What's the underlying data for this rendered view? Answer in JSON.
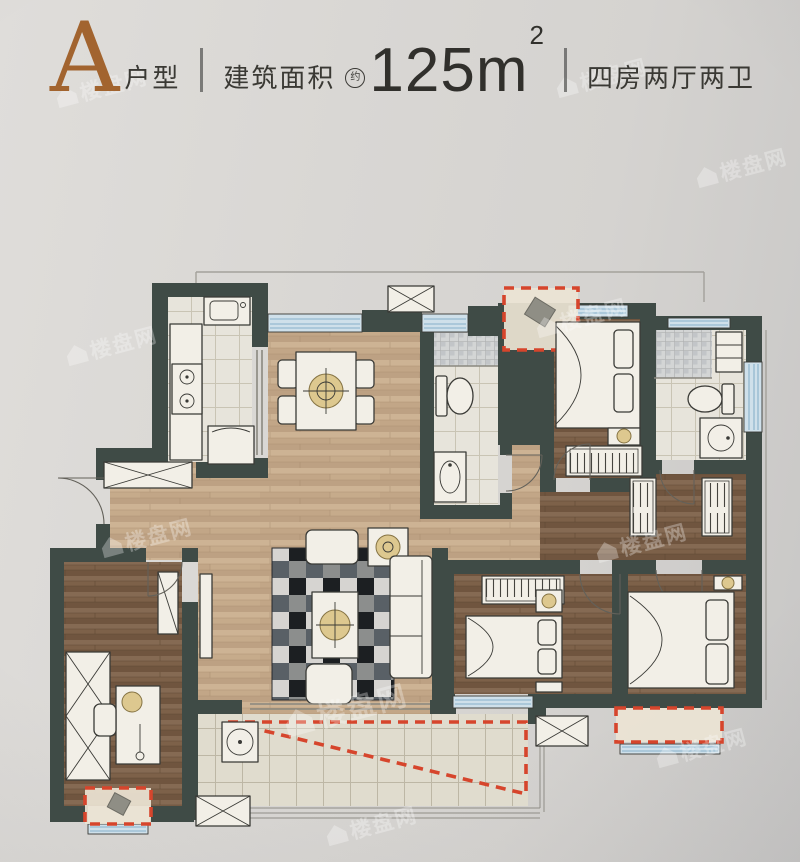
{
  "header": {
    "plan_letter": "A",
    "plan_type_label": "户型",
    "area_label": "建筑面积",
    "area_prefix": "约",
    "area_value": "125",
    "area_unit_base": "m",
    "area_unit_exponent": "2",
    "rooms_summary": "四房两厅两卫"
  },
  "watermark": {
    "brand_text": "楼盘网",
    "logo_icon": "house-icon"
  },
  "floorplan": {
    "icons": {
      "bay_window_marker": "red-dashed-rect",
      "ac_platform_marker": "crossed-box",
      "approx_badge": "circled-character"
    },
    "colors": {
      "background": "#d8d5d2",
      "wall": "#3f4b46",
      "wood_light": "#c3a584",
      "wood_dark": "#7b604a",
      "tile": "#e6e3da",
      "window_blue": "#9fc0d4",
      "highlight_red": "#d6452c",
      "furniture": "#f2efe7",
      "lamp_accent": "#ddc88f",
      "rug_dark": "#2f3236",
      "letter_accent": "#a2642f",
      "text_dark": "#35342f"
    }
  }
}
